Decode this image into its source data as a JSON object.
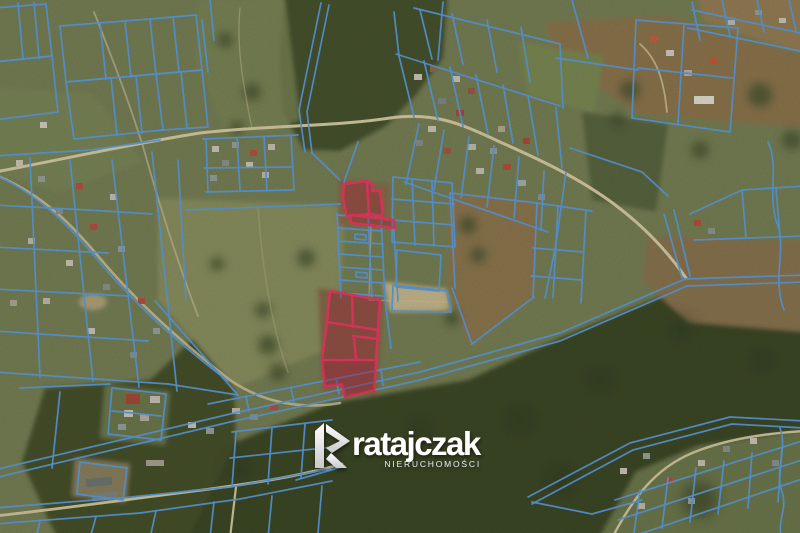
{
  "watermark": {
    "brand": "ratajczak",
    "tagline": "NIERUCHOMOŚCI"
  },
  "icons": {
    "logo_mark": "stylized-letter-R-ribbon"
  },
  "colors": {
    "parcel_line": "#5c9ee2",
    "highlight_stroke": "#ea3a60",
    "highlight_fill": "#b01940",
    "watermark_text": "#ffffff",
    "watermark_tagline": "#e9e9e9"
  }
}
